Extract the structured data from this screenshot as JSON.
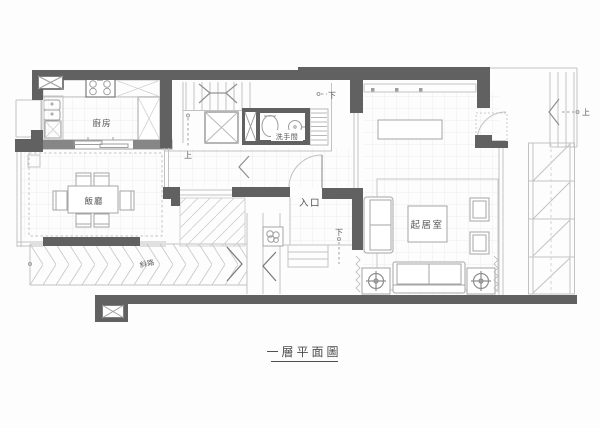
{
  "drawing_title": "一層平面圖",
  "rooms": {
    "kitchen": "廚房",
    "dining_room": "飯廳",
    "washroom": "洗手間",
    "entrance": "入口",
    "living_room": "起居室",
    "ramp": "斜路"
  },
  "direction_markers": {
    "stairs_up_main": "上",
    "stairs_down_closet": "下",
    "porch_down": "下",
    "exterior_stairs_up": "上"
  },
  "palette": {
    "wall": "#616161",
    "furniture_line": "#9e9e9e",
    "light_line": "#c2c2c2",
    "grid_line": "#ededed",
    "label_text": "#555555"
  }
}
